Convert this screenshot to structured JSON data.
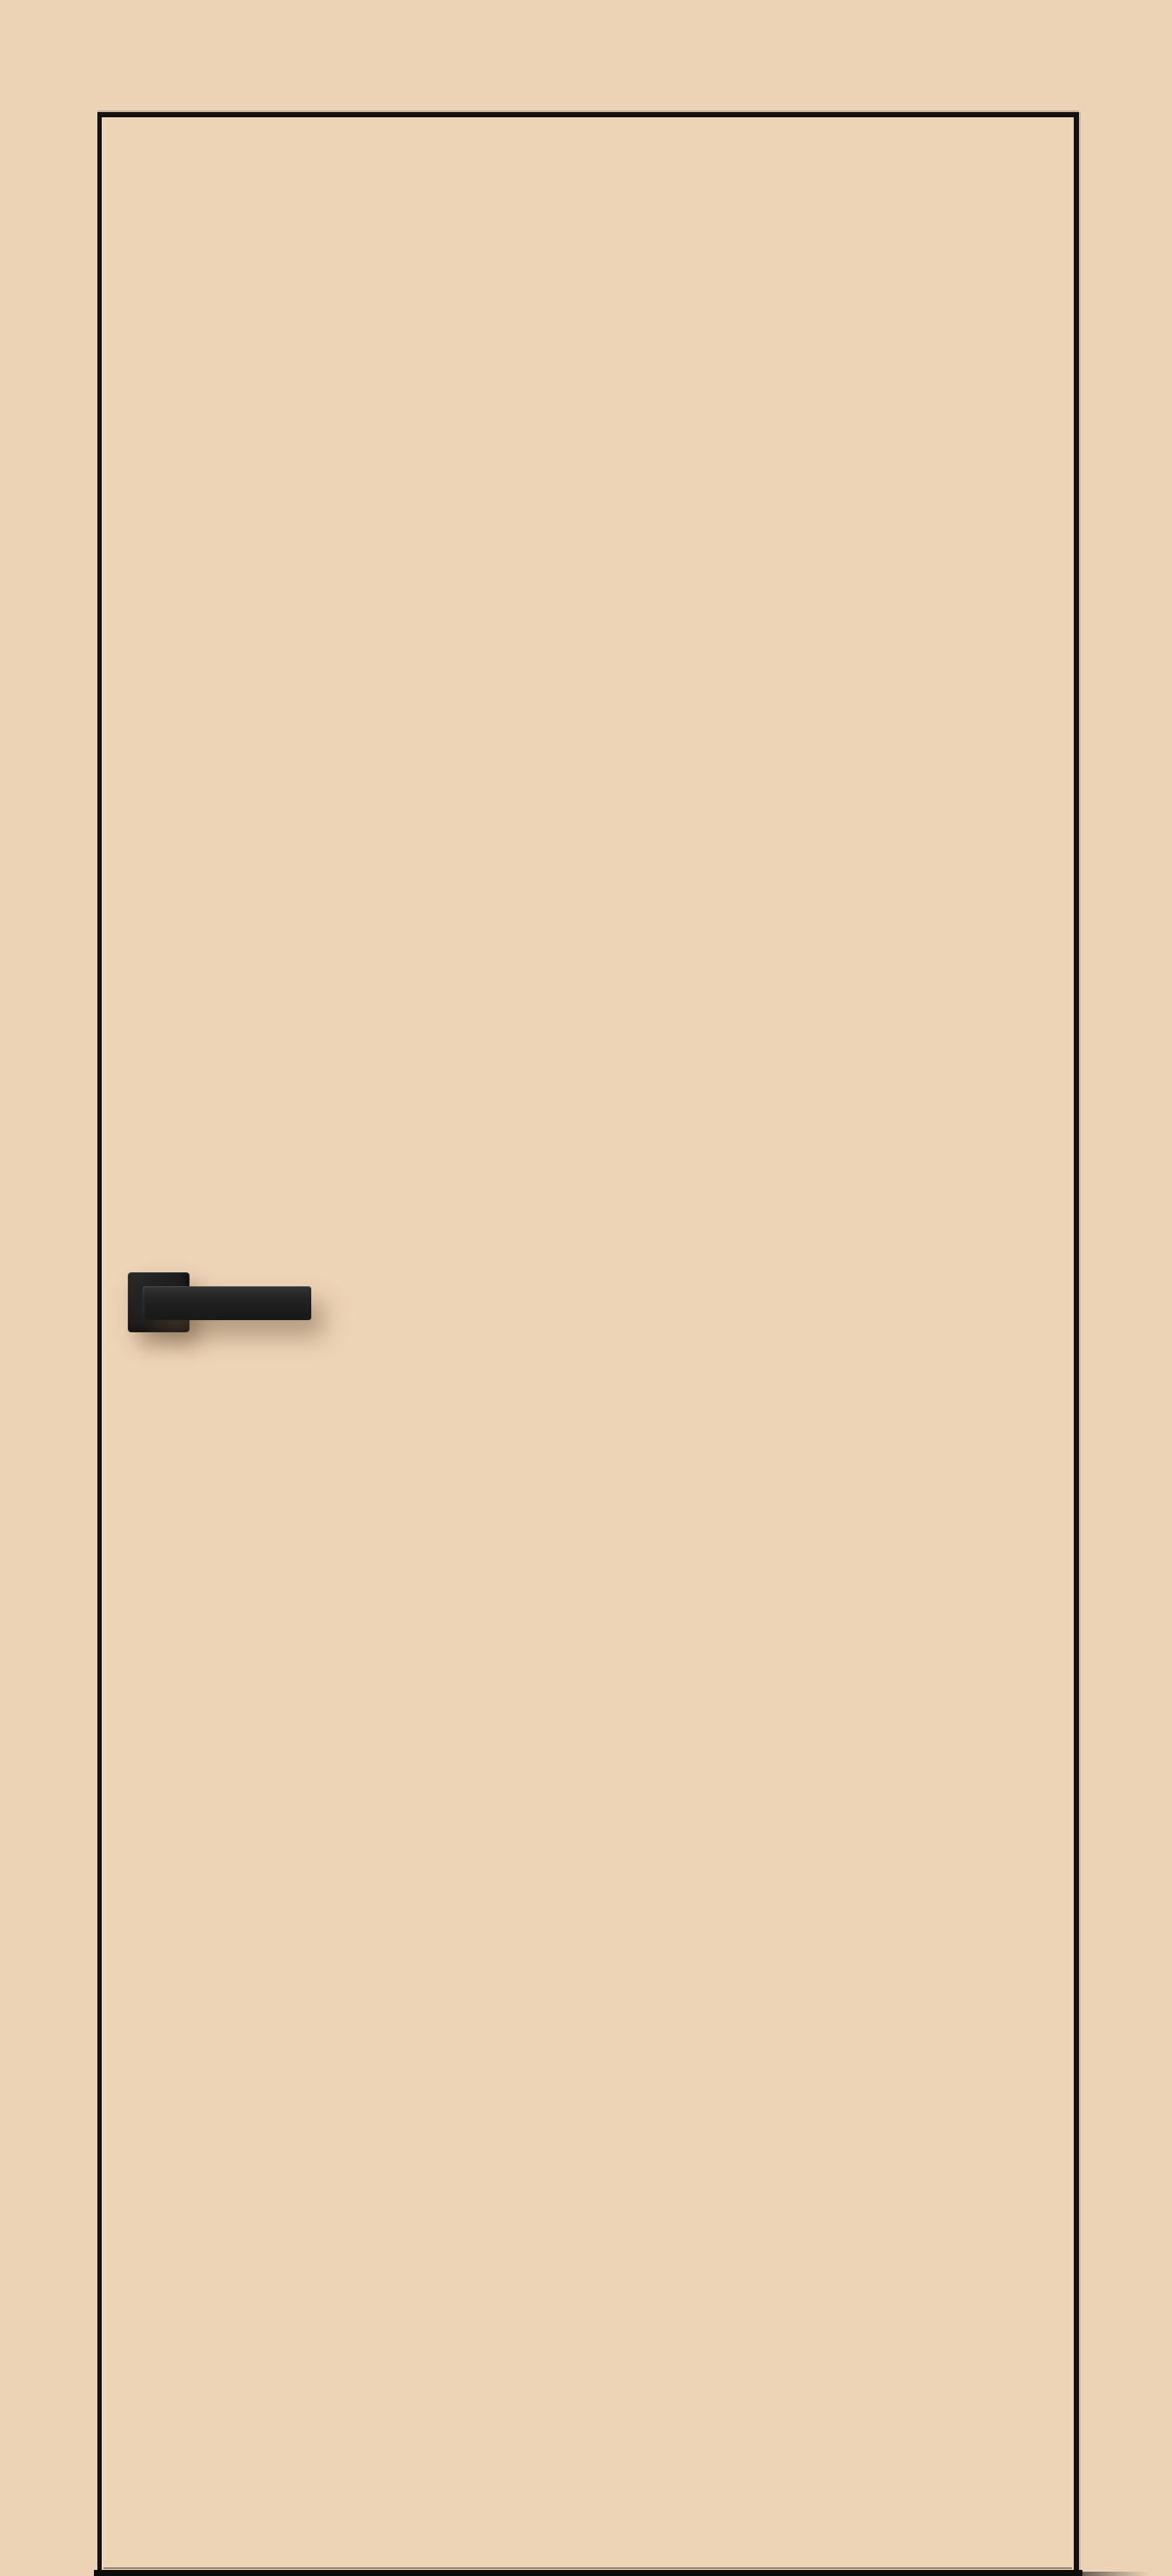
{
  "scene": {
    "type": "product-photo",
    "description": "Plain beige flush interior door leaf with a thin black edge outline, a matte black square-rosette lever handle on the left side, and a dark floor gap at the bottom",
    "objects": {
      "backdrop": "beige wall background",
      "door_panel": "flush beige door leaf with dark edge trim",
      "door_handle": "matte black lever handle on square rosette, pointing right",
      "handle_rosette": "square black rosette backplate",
      "handle_lever": "straight rectangular black lever bar",
      "door_bottom_edge_line": "thin seam line above the floor gap",
      "door_bottom_gap": "dark gap strip between door and floor",
      "floor_shadow": "soft grey shadow trailing right of the door at floor level"
    },
    "colors": {
      "background": "#edd3b5",
      "door_face": "#eed4b7",
      "door_outline": "#151110",
      "handle_dark": "#1e1e1e",
      "handle_light": "#343434",
      "bottom_gap": "#0d0b09",
      "shadow": "rgba(104,79,54,0.45)"
    }
  }
}
